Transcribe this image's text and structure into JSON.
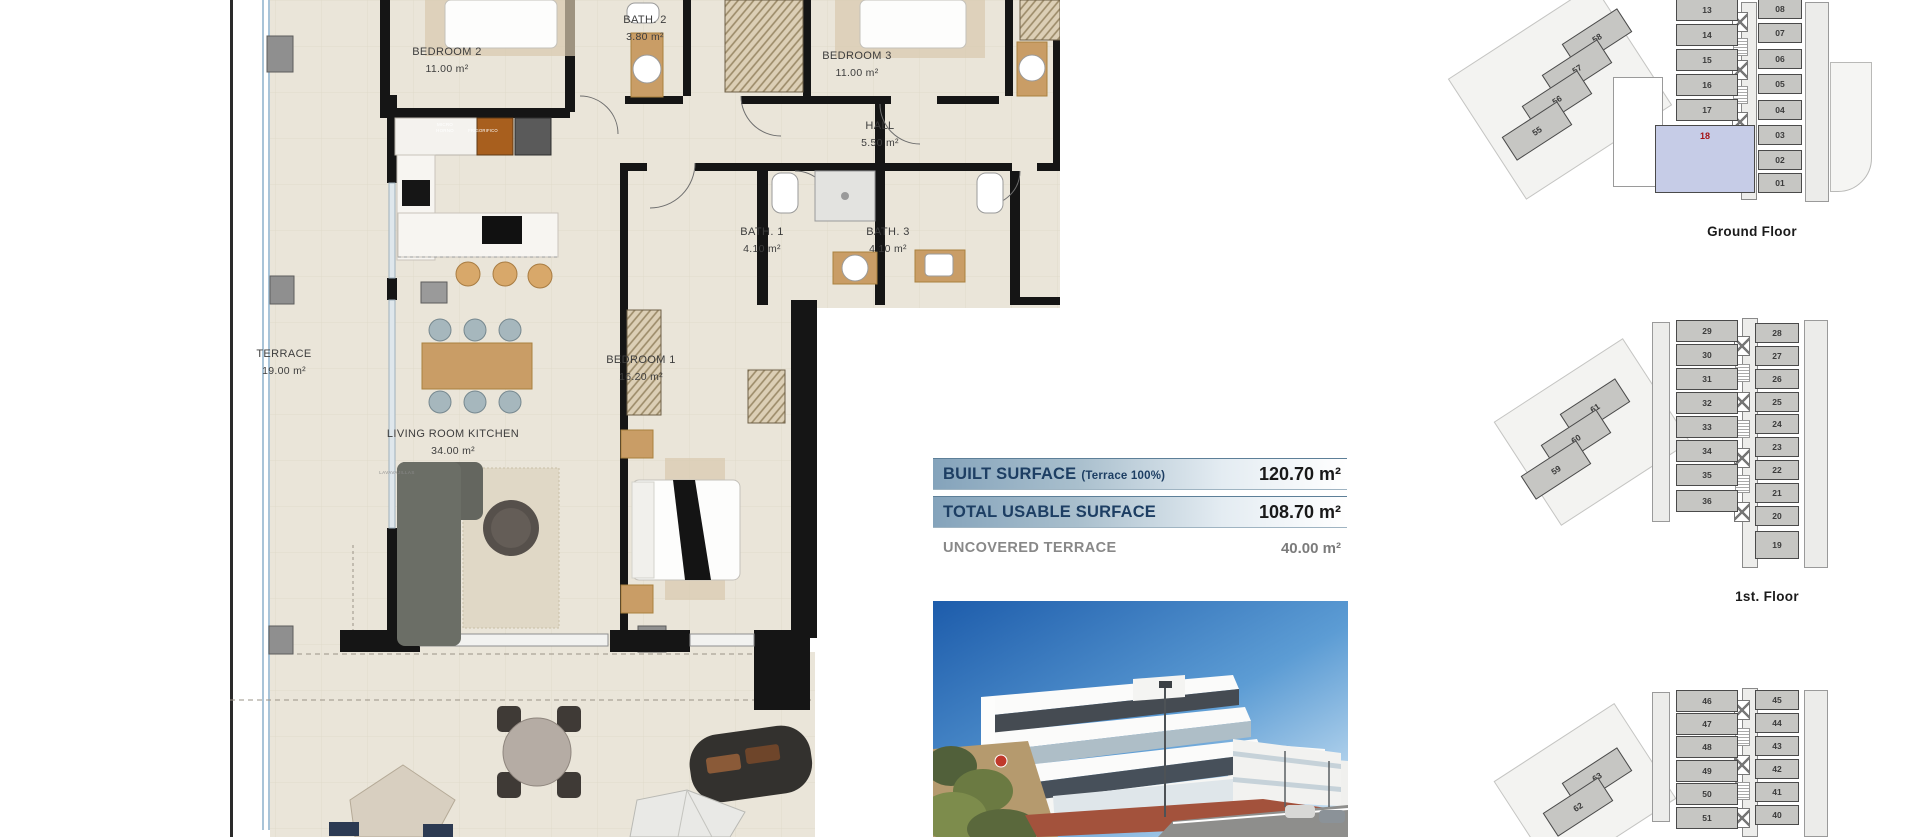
{
  "plan": {
    "bedroom2": {
      "name": "BEDROOM 2",
      "area": "11.00 m²"
    },
    "bath2": {
      "name": "BATH. 2",
      "area": "3.80 m²"
    },
    "bedroom3": {
      "name": "BEDROOM 3",
      "area": "11.00 m²"
    },
    "hall": {
      "name": "HALL",
      "area": "5.50 m²"
    },
    "bath1": {
      "name": "BATH. 1",
      "area": "4.10 m²"
    },
    "bath3": {
      "name": "BATH. 3",
      "area": "4.10 m²"
    },
    "terrace": {
      "name": "TERRACE",
      "area": "19.00 m²"
    },
    "bedroom1": {
      "name": "BEDROOM 1",
      "area": "16.20 m²"
    },
    "living": {
      "name": "LIVING ROOM KITCHEN",
      "area": "34.00 m²"
    },
    "labels": {
      "micro": "MICRO HORNO",
      "fridge": "FRIGORIFICO",
      "dishwasher": "LAVAVAJILLAS"
    }
  },
  "surfaces": {
    "built": {
      "label": "BUILT SURFACE",
      "note": "(Terrace 100%)",
      "value": "120.70 m²"
    },
    "usable": {
      "label": "TOTAL USABLE SURFACE",
      "value": "108.70 m²"
    },
    "uncovered": {
      "label": "UNCOVERED TERRACE",
      "value": "40.00 m²"
    }
  },
  "floors": {
    "ground": {
      "label": "Ground Floor",
      "highlight": "18",
      "left": [
        "13",
        "14",
        "15",
        "16",
        "17"
      ],
      "right": [
        "08",
        "07",
        "06",
        "05",
        "04",
        "03",
        "02",
        "01"
      ],
      "wing": [
        "58",
        "57",
        "56",
        "55"
      ]
    },
    "first": {
      "label": "1st. Floor",
      "left": [
        "29",
        "30",
        "31",
        "32",
        "33",
        "34",
        "35",
        "36"
      ],
      "right": [
        "28",
        "27",
        "26",
        "25",
        "24",
        "23",
        "22",
        "21",
        "20",
        "19"
      ],
      "wing": [
        "61",
        "60",
        "59"
      ]
    },
    "second": {
      "left": [
        "46",
        "47",
        "48",
        "49",
        "50",
        "51"
      ],
      "right": [
        "45",
        "44",
        "43",
        "42",
        "41",
        "40"
      ],
      "wing": [
        "63",
        "62"
      ]
    }
  },
  "colors": {
    "accent_bar": "#84a3bb",
    "label_navy": "#1d3e63",
    "floor_beige": "#eae5d9",
    "wall_black": "#151515",
    "highlight_unit": "#c6cce7",
    "highlight_number": "#a51317",
    "wood": "#c99d66",
    "sky": "#2263ae"
  }
}
